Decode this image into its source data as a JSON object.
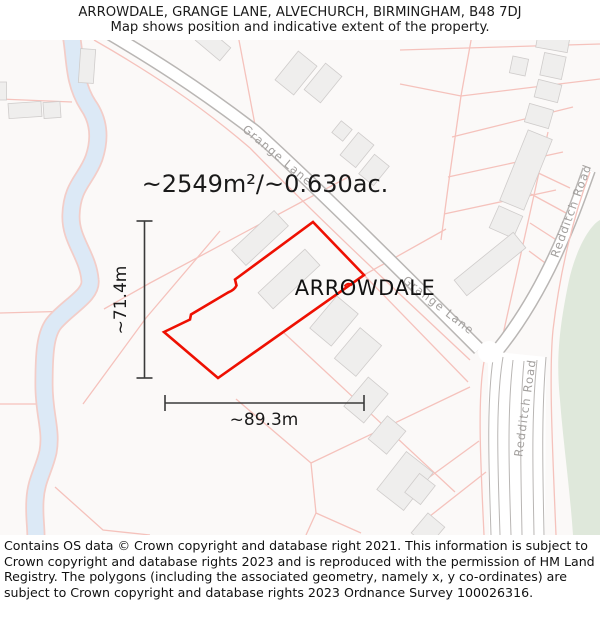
{
  "header": {
    "title": "ARROWDALE, GRANGE LANE, ALVECHURCH, BIRMINGHAM, B48 7DJ",
    "subtitle": "Map shows position and indicative extent of the property."
  },
  "map": {
    "area_label": "~2549m²/~0.630ac.",
    "property_label": "ARROWDALE",
    "dim_width_label": "~89.3m",
    "dim_height_label": "~71.4m",
    "road_labels": {
      "grange_lane_upper": "Grange Lane",
      "grange_lane_lower": "Grange Lane",
      "redditch_road_upper": "Redditch Road",
      "redditch_road_lower": "Redditch Road"
    },
    "colors": {
      "property_outline": "#ee1002",
      "parcel_line": "#f5c2bc",
      "road_casing": "#b9b6b4",
      "building_fill": "#efeeed",
      "green_area": "#dfe8db",
      "water": "#dce9f6",
      "water_edge": "#f3cdc8",
      "dimension_line": "#3a3a3a",
      "road_label": "#a3a09e",
      "map_background": "#fbf9f8"
    }
  },
  "footer": {
    "text": "Contains OS data © Crown copyright and database right 2021. This information is subject to Crown copyright and database rights 2023 and is reproduced with the permission of HM Land Registry. The polygons (including the associated geometry, namely x, y co-ordinates) are subject to Crown copyright and database rights 2023 Ordnance Survey 100026316."
  }
}
